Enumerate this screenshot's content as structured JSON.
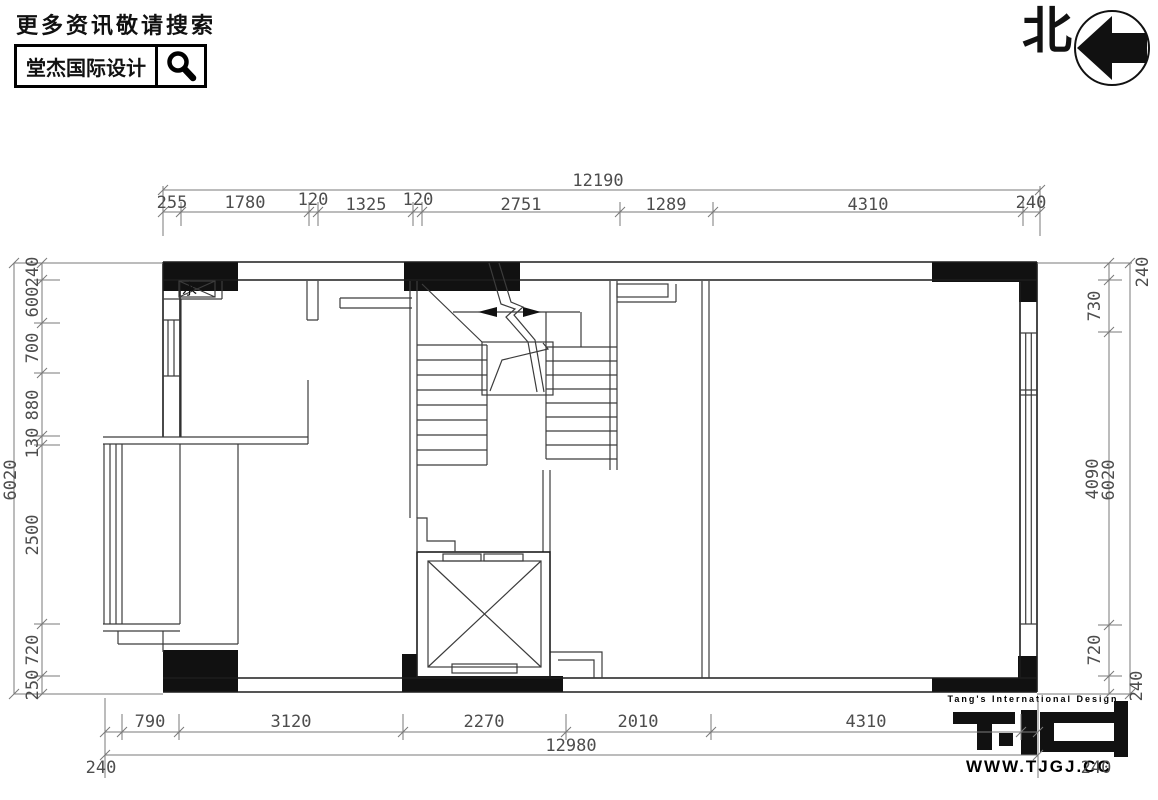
{
  "header": {
    "tagline": "更多资讯敬请搜索",
    "brand": "堂杰国际设计"
  },
  "north": {
    "label": "北"
  },
  "plan": {
    "water_label": "水"
  },
  "dims": {
    "top": {
      "total": "12190",
      "segments": [
        "255",
        "1780",
        "120",
        "1325",
        "120",
        "2751",
        "1289",
        "4310",
        "240"
      ]
    },
    "left": {
      "total": "6020",
      "segments": [
        "240",
        "600",
        "700",
        "880",
        "130",
        "2500",
        "720",
        "250"
      ]
    },
    "right": {
      "total": "6020",
      "segments": [
        "240",
        "730",
        "4090",
        "720",
        "240"
      ]
    },
    "bottom": {
      "total": "12980",
      "left_end": "240",
      "right_end": "240",
      "segments": [
        "790",
        "3120",
        "2270",
        "2010",
        "4310"
      ]
    }
  },
  "logo": {
    "caption": "Tang's International Design",
    "website": "WWW.TJGJ.CC"
  }
}
